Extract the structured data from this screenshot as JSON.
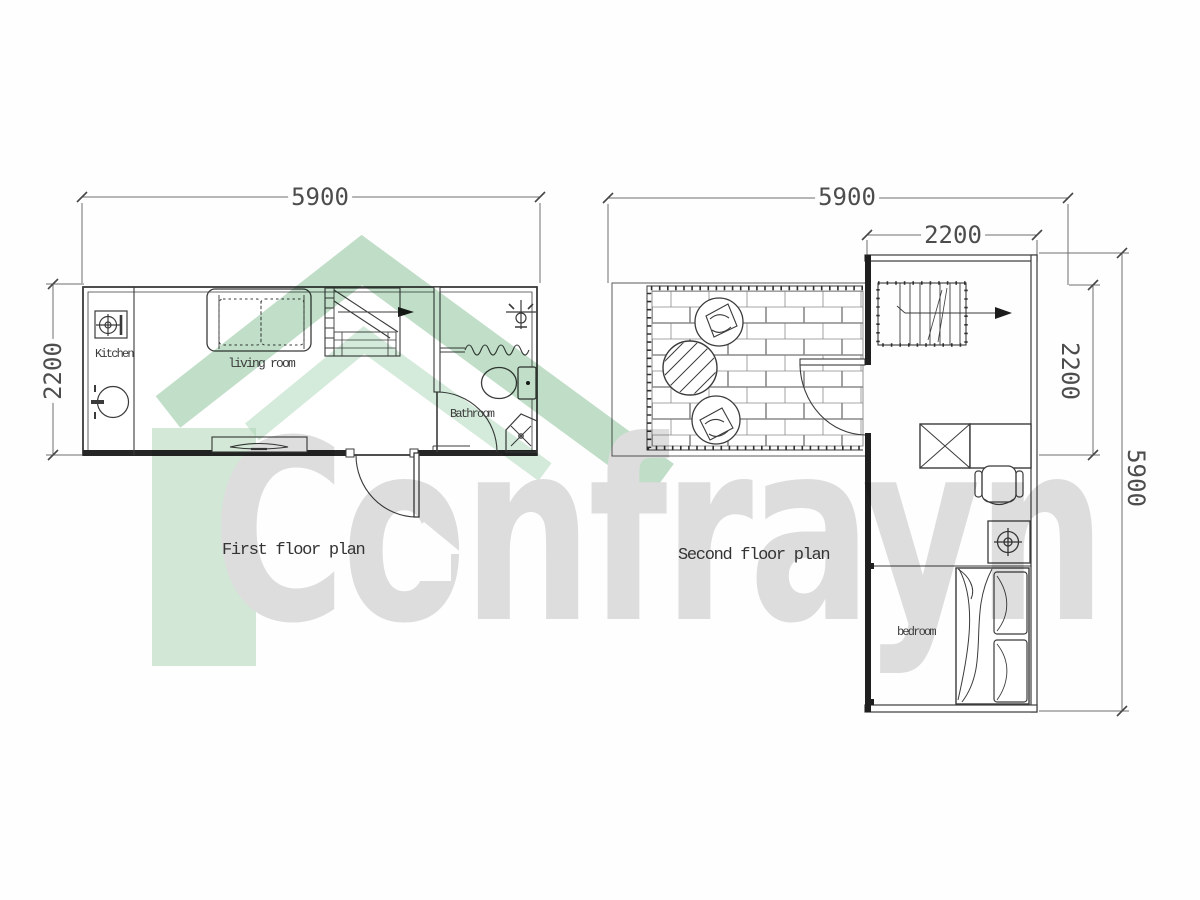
{
  "watermark": {
    "brand": "Confrayn"
  },
  "first_floor": {
    "title": "First floor plan",
    "labels": {
      "kitchen": "Kitchen",
      "living_room": "living room",
      "bathroom": "Bathroom"
    },
    "dimensions": {
      "width": "5900",
      "depth": "2200"
    }
  },
  "second_floor": {
    "title": "Second floor plan",
    "labels": {
      "bedroom": "bedroom"
    },
    "dimensions": {
      "overall_width": "5900",
      "room_width": "2200",
      "terrace_depth": "2200",
      "room_length": "5900"
    }
  }
}
